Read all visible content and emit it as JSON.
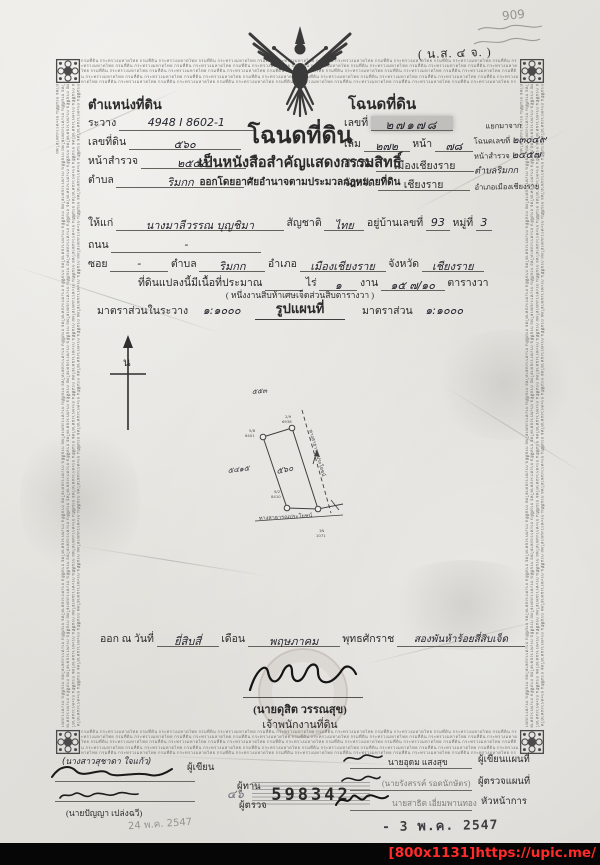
{
  "meta": {
    "watermark": "[800x1131]https://upic.me/",
    "pencil_note": "909",
    "form_code": "( น.ส. ๔ จ. )"
  },
  "border": {
    "microtext": "กรมที่ดิน กระทรวงมหาดไทย"
  },
  "position": {
    "title": "ตำแหน่งที่ดิน",
    "rawang_label": "ระวาง",
    "rawang": "4948 I 8602-1",
    "parcel_label": "เลขที่ดิน",
    "parcel": "๕๖๐",
    "survey_label": "หน้าสำรวจ",
    "survey": "๒๕๕๕",
    "tambon_label": "ตำบล",
    "tambon": "ริมกก"
  },
  "deed": {
    "title": "โฉนดที่ดิน",
    "no_label": "เลขที่",
    "no": "๒๗๑๗๘",
    "vol_label": "เล่ม",
    "vol": "๒๗๒",
    "page_label": "หน้า",
    "page": "๗๘",
    "amphoe_label": "อำเภอ",
    "amphoe": "เมืองเชียงราย",
    "province_label": "จังหวัด",
    "province": "เชียงราย"
  },
  "split": {
    "title": "แยกมาจาก",
    "deed_label": "โฉนดเลขที่",
    "deed_no": "๒๓๐๔๙",
    "survey_label": "หน้าสำรวจ",
    "survey": "๒๔๕๗",
    "tambon": "ตำบลริมกก",
    "amphoe": "อำเภอเมืองเชียงราย"
  },
  "heading": {
    "title": "โฉนดที่ดิน",
    "sub1": "เป็นหนังสือสำคัญแสดงกรรมสิทธิ์",
    "sub2": "ออกโดยอาศัยอำนาจตามประมวลกฎหมายที่ดิน"
  },
  "owner": {
    "given_label": "ให้แก่",
    "name": "นางมาลีวรรณ บุญชิมา",
    "nationality_label": "สัญชาติ",
    "nationality": "ไทย",
    "address_label": "อยู่บ้านเลขที่",
    "address_no": "93",
    "moo_label": "หมู่ที่",
    "moo": "3",
    "road_label": "ถนน",
    "road": "-",
    "soi_label": "ซอย",
    "soi": "-",
    "tambon_label": "ตำบล",
    "tambon": "ริมกก",
    "amphoe_label": "อำเภอ",
    "amphoe": "เมืองเชียงราย",
    "province_label": "จังหวัด",
    "province": "เชียงราย"
  },
  "area": {
    "prefix": "ที่ดินแปลงนี้มีเนื้อที่ประมาณ",
    "rai_label": "ไร่",
    "rai": "",
    "ngan_label": "งาน",
    "ngan": "๑",
    "wa_label": "ตารางวา",
    "wa": "๑๕ ๗/๑๐",
    "spelled": "( หนึ่งงานสิบห้าเศษเจ็ดส่วนสิบตารางวา )"
  },
  "scale": {
    "in_sheet_label": "มาตราส่วนในระวาง",
    "in_sheet": "๑:๑๐๐๐",
    "map_title": "รูปแผนที่",
    "scale_label": "มาตราส่วน",
    "scale": "๑:๑๐๐๐"
  },
  "map": {
    "north": "น",
    "parcel_no": "๕๖๐",
    "adj_left": "๕๔๑๕",
    "adj_top": "๕๕๓",
    "road_right": "ทางสาธารณประโยชน์",
    "road_bottom": "ทางสาธารณประโยชน์",
    "marker_top_a": "2/9",
    "marker_top_b": "6938",
    "marker_left_a": "5/8",
    "marker_left_b": "6401",
    "marker_bl_a": "9/2",
    "marker_bl_b": "8410",
    "marker_br_a": "1N",
    "marker_br_b": "1071"
  },
  "issue": {
    "prefix": "ออก ณ วันที่",
    "day": "ยี่สิบสี่",
    "month_label": "เดือน",
    "month": "พฤษภาคม",
    "era_label": "พุทธศักราช",
    "year": "สองพันห้าร้อยสี่สิบเจ็ด",
    "officer": "(นายดุสิต วรรณสุข)",
    "officer_title": "เจ้าพนักงานที่ดิน"
  },
  "left_sign": {
    "writer_name": "(นางสาวสุชาดา ใจแก้ว)",
    "writer_role": "ผู้เขียน",
    "checker_role": "ผู้ทาน",
    "inspector_role": "ผู้ตรวจ",
    "inspector_name": "(นายปัญญา เปล่งฉวี)",
    "pencil_date": "24 พ.ค. 2547"
  },
  "serial": {
    "pencil": "๔๖",
    "number": "598342"
  },
  "right_sign": {
    "map_writer": "นายอุดม แสงสุข",
    "map_writer_role": "ผู้เขียนแผนที่",
    "map_checker": "(นายรังสรรค์ รอดนักษัตร)",
    "map_checker_role": "ผู้ตรวจแผนที่",
    "head": "นายสาธิต เอี่ยมพานทอง",
    "head_role": "หัวหน้าการ",
    "date_stamp": "- 3 พ.ค. 2547"
  }
}
